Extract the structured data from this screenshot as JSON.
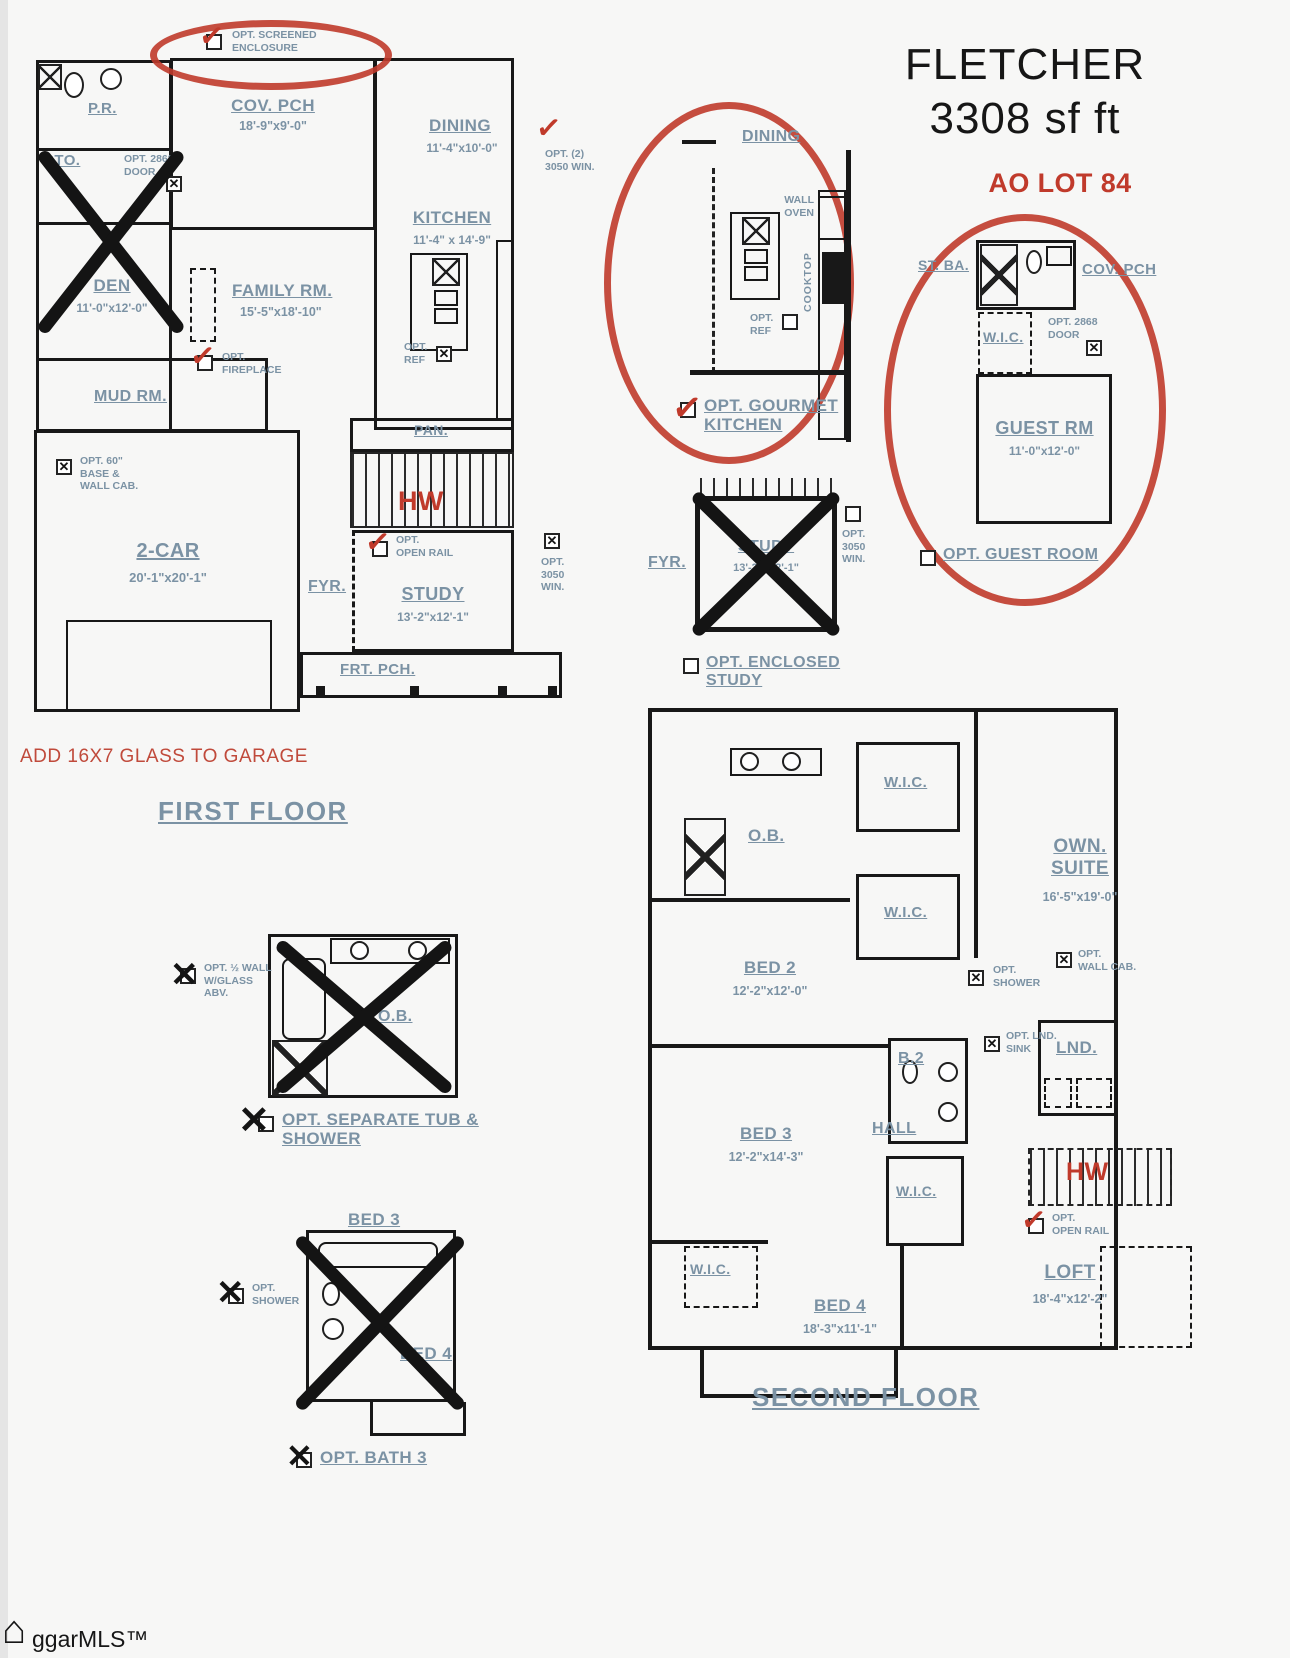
{
  "icons": {
    "check": "✓",
    "x": "✕",
    "house": "⌂"
  },
  "title": {
    "name": "FLETCHER",
    "size": "3308 sf ft",
    "lot": "AO LOT 84"
  },
  "floor1": {
    "heading": "FIRST FLOOR",
    "cov_pch": "COV. PCH",
    "cov_pch_dim": "18'-9\"x9'-0\"",
    "pr": "P.R.",
    "sto": "STO.",
    "den": "DEN",
    "den_dim": "11'-0\"x12'-0\"",
    "dining": "DINING",
    "dining_dim": "11'-4\"x10'-0\"",
    "kitchen": "KITCHEN",
    "kitchen_dim": "11'-4\" x 14'-9\"",
    "family": "FAMILY RM.",
    "family_dim": "15'-5\"x18'-10\"",
    "mud": "MUD RM.",
    "two_car": "2-CAR",
    "two_car_dim": "20'-1\"x20'-1\"",
    "fyr": "FYR.",
    "study": "STUDY",
    "study_dim": "13'-2\"x12'-1\"",
    "pan": "PAN.",
    "hw": "HW",
    "frt_pch": "FRT. PCH.",
    "opt_screened": "OPT. SCREENED\nENCLOSURE",
    "opt_2868_door": "OPT. 2868\nDOOR",
    "opt_2_3050_win": "OPT. (2)\n3050 WIN.",
    "opt_fireplace": "OPT.\nFIREPLACE",
    "opt_ref": "OPT.\nREF",
    "opt_60_base": "OPT. 60\"\nBASE &\nWALL CAB.",
    "opt_open_rail": "OPT.\nOPEN RAIL",
    "opt_3050_win": "OPT.\n3050\nWIN.",
    "add_glass_note": "ADD 16X7 GLASS TO GARAGE"
  },
  "gourmet": {
    "dining": "DINING",
    "wall_oven": "WALL\nOVEN",
    "cooktop": "COOKTOP",
    "opt_ref": "OPT.\nREF",
    "caption": "OPT. GOURMET\nKITCHEN"
  },
  "enclosed_study": {
    "fyr": "FYR.",
    "study": "STUDY",
    "study_dim": "13'-2\"x12'-1\"",
    "opt_3050_win": "OPT.\n3050\nWIN.",
    "caption": "OPT. ENCLOSED\nSTUDY"
  },
  "guest": {
    "st_ba": "ST. BA.",
    "cov_pch": "COV. PCH",
    "wic": "W.I.C.",
    "opt_2868_door": "OPT. 2868\nDOOR",
    "guest_rm": "GUEST RM",
    "guest_rm_dim": "11'-0\"x12'-0\"",
    "caption": "OPT. GUEST ROOM"
  },
  "floor2": {
    "heading": "SECOND FLOOR",
    "ob": "O.B.",
    "wic": "W.I.C.",
    "own_suite": "OWN.\nSUITE",
    "own_suite_dim": "16'-5\"x19'-0\"",
    "bed2": "BED 2",
    "bed2_dim": "12'-2\"x12'-0\"",
    "bed3": "BED 3",
    "bed3_dim": "12'-2\"x14'-3\"",
    "bed4": "BED 4",
    "bed4_dim": "18'-3\"x11'-1\"",
    "b2": "B.2",
    "hall": "HALL",
    "lnd": "LND.",
    "loft": "LOFT",
    "loft_dim": "18'-4\"x12'-2\"",
    "hw": "HW",
    "opt_shower": "OPT.\nSHOWER",
    "opt_wall_cab": "OPT.\nWALL CAB.",
    "opt_lnd_sink": "OPT. LND.\nSINK",
    "opt_open_rail": "OPT.\nOPEN RAIL"
  },
  "tub_inset": {
    "ob": "O.B.",
    "opt_half_wall": "OPT. ½ WALL\nW/GLASS\nABV.",
    "caption": "OPT. SEPARATE TUB &\nSHOWER"
  },
  "bath3_inset": {
    "bed3": "BED 3",
    "bed4": "BED 4",
    "opt_shower": "OPT.\nSHOWER",
    "caption": "OPT. BATH 3"
  },
  "watermark": "ggarMLS™",
  "colors": {
    "accent_red": "#c03a2b",
    "label_blue": "#7b92a4",
    "wall_black": "#181818"
  }
}
